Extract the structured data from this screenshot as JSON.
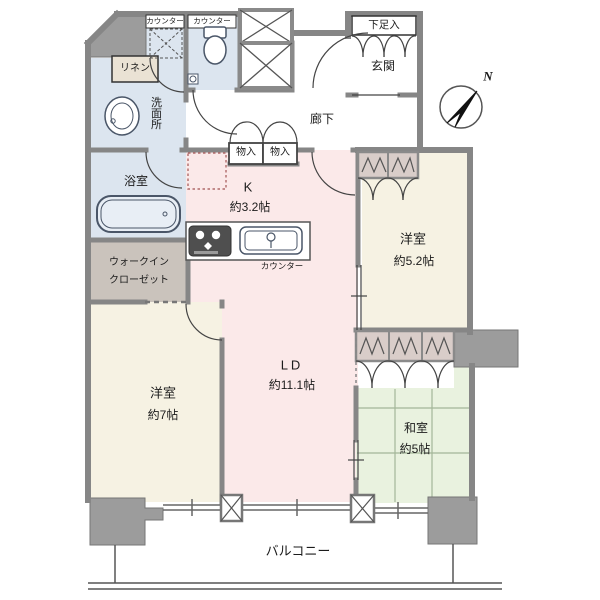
{
  "plan_title": "residential-floor-plan",
  "rooms": {
    "kitchen": {
      "name": "K",
      "size": "約3.2帖"
    },
    "living_dining": {
      "name": "LD",
      "size": "約11.1帖"
    },
    "bedroom_left": {
      "name": "洋室",
      "size": "約7帖"
    },
    "bedroom_right": {
      "name": "洋室",
      "size": "約5.2帖"
    },
    "japanese_room": {
      "name": "和室",
      "size": "約5帖"
    },
    "bathroom": {
      "name": "浴室"
    },
    "washroom": {
      "name": "洗面所"
    },
    "walk_in_closet": {
      "line1": "ウォークイン",
      "line2": "クローゼット"
    },
    "entrance": {
      "name": "玄関"
    },
    "corridor": {
      "name": "廊下"
    },
    "balcony": {
      "name": "バルコニー"
    }
  },
  "labels": {
    "counter_washroom": "カウンター",
    "counter_toilet": "カウンター",
    "counter_kitchen": "カウンター",
    "linen": "リネン",
    "storage_left": "物入",
    "storage_right": "物入",
    "shoe_cabinet": "下足入",
    "north": "N"
  },
  "icons": [
    "north-compass-icon",
    "toilet-icon",
    "bathtub-icon",
    "washbasin-icon",
    "stove-icon",
    "kitchen-sink-icon",
    "washing-machine-space-icon",
    "refrigerator-space-icon",
    "hanger-rod-icon",
    "shaft-x-icon",
    "pillar-x-icon"
  ],
  "colors": {
    "wall": "#8a8a8a",
    "pillar": "#9c9c9c",
    "room_pink": "#fbe9e9",
    "room_cream": "#f6f2e3",
    "room_green": "#e9f2df",
    "room_blue": "#dce5ef",
    "wic_tan": "#cac3bc",
    "closet_band": "#d9cdc9",
    "linen_bg": "#eae2d4",
    "line_dark": "#444444"
  }
}
